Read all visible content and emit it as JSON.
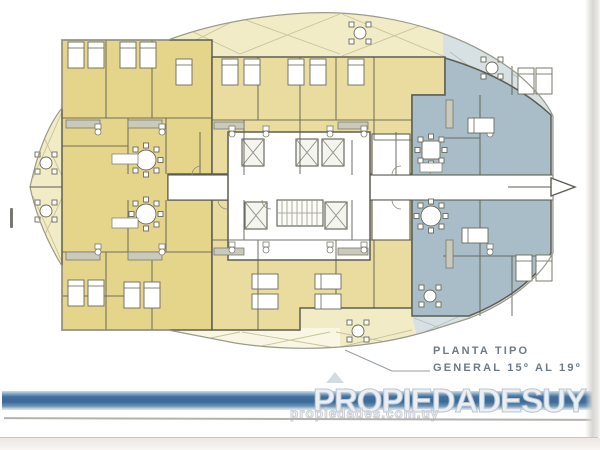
{
  "annotation": {
    "line1": "PLANTA TIPO",
    "line2": "GENERAL 15º AL 19º"
  },
  "watermark": {
    "brand": "PROPIEDADESUY",
    "url": "propiedades.com.uy"
  },
  "icons": {
    "elevator_icon": "crossed-box",
    "stairs_icon": "tread-lines",
    "direction_arrow_icon": "hollow-right-triangle",
    "logo_house_icon": "roof-triangle",
    "balcony_table_icon": "round-table-with-chairs"
  },
  "colors": {
    "pale-yellow": "#f2ecc6",
    "yellow": "#e5d58a",
    "tan": "#e9dc9e",
    "slate": "#a8bdc7",
    "pale-slate": "#d7e0e2",
    "wall": "#5d5d52",
    "wall-soft": "#8c8c80",
    "edge": "#9a9a8c",
    "brace-y": "#c9c29b",
    "brace-s": "#b3bfc4",
    "label": "#6e7a85",
    "banner-blue": "#42709e",
    "watermark-fill": "#eceff2",
    "watermark-stroke": "#b7c5d3",
    "url-stroke": "#c9cfd6"
  }
}
